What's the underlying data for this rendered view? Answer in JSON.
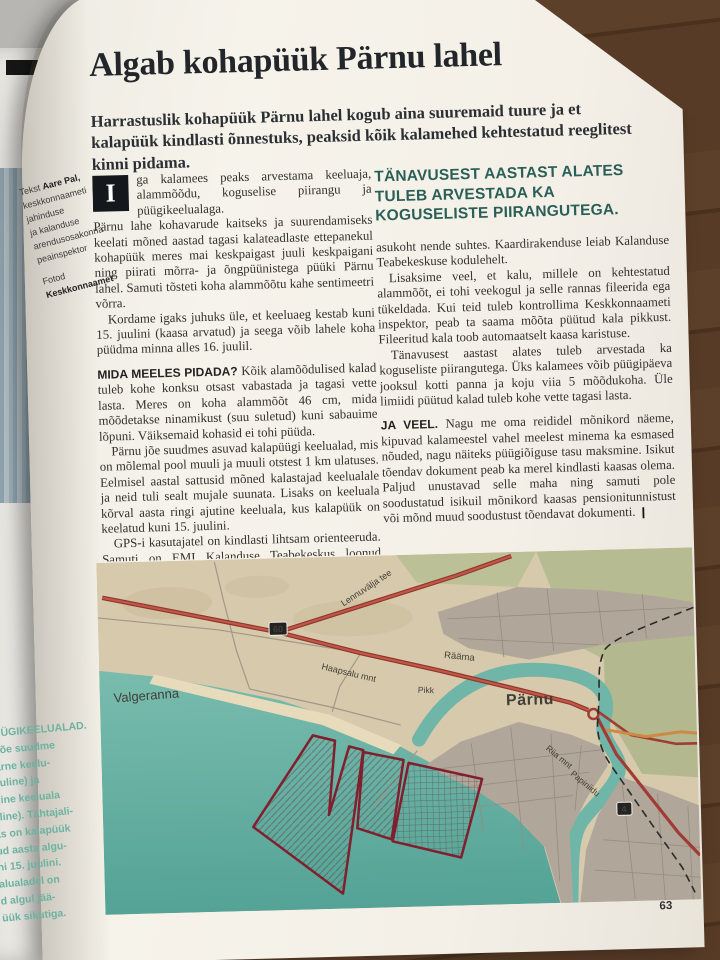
{
  "page": {
    "number": "63"
  },
  "article": {
    "title": "Algab kohapüük Pärnu lahel",
    "lede": "Harrastuslik kohapüük Pärnu lahel kogub aina suuremaid tuure ja et kalapüük kindlasti õnnestuks, peaksid kõik kalamehed kehtestatud reeglitest kinni pidama.",
    "credit": {
      "prefix": "Tekst",
      "name": "Aare Pal,",
      "lines": [
        "keskkonnaameti",
        "jahinduse",
        "ja kalanduse",
        "arendusosakonna",
        "peainspektor"
      ],
      "photo_prefix": "Fotod",
      "photo_credit": "Keskkonnaamet"
    },
    "dropcap": "I",
    "left": {
      "p1": "ga kalamees peaks arvestama keeluaja, alammõõdu, koguselise piirangu ja püügikeelualaga.",
      "p2": "Pärnu lahe kohavarude kaitseks ja suurendamiseks keelati mõned aastad tagasi kalateadlaste ettepanekul kohapüük meres mai keskpaigast juuli keskpaigani ning piirati mõrra- ja õngpüünistega püüki Pärnu lahel. Samuti tõsteti koha alammõõtu kahe sentimeetri võrra.",
      "p3": "Kordame igaks juhuks üle, et keeluaeg kestab kuni 15. juulini (kaasa arvatud) ja seega võib lahele koha püüdma minna alles 16. juulil.",
      "h1": "MIDA MEELES PIDADA?",
      "p4": "Kõik alamõõdulised kalad tuleb kohe konksu otsast vabastada ja tagasi vette lasta. Meres on koha alammõõt 46 cm, mida mõõdetakse ninamikust (suu suletud) kuni sabauime lõpuni. Väiksemaid kohasid ei tohi püüda.",
      "p5": "Pärnu jõe suudmes asuvad kalapüügi keelualad, mis on mõlemal pool muuli ja muuli otstest 1 km ulatuses. Eelmisel aastal sattusid mõned kalastajad keelualale ja neid tuli sealt mujale suunata. Lisaks on keeluala kõrval aasta ringi ajutine keeluala, kus kalapüük on keelatud kuni 15. juulini.",
      "p6": "GPS-i kasutajatel on kindlasti lihtsam orienteeruda. Samuti on EMI Kalanduse Teabekeskus loonud nutisõbraliku kaardirakenduse, milles on võimalik keelualasid kaardil näha ja määrata enda"
    },
    "callout": "TÄNAVUSEST AASTAST ALATES TULEB ARVESTADA KA KOGUSELISTE PIIRANGUTEGA.",
    "right": {
      "p1": "asukoht nende suhtes. Kaardirakenduse leiab Kalanduse Teabekeskuse kodulehelt.",
      "p2": "Lisaksime veel, et kalu, millele on kehtestatud alammõõt, ei tohi veekogul ja selle rannas fileerida ega tükeldada. Kui teid tuleb kontrollima Keskkonnaameti inspektor, peab ta saama mõõta püütud kala pikkust. Fileeritud kala toob automaatselt kaasa karistuse.",
      "p3": "Tänavusest aastast alates tuleb arvestada ka koguseliste piirangutega. Üks kalamees võib püügipäeva jooksul kotti panna ja koju viia 5 mõõdukoha. Üle limiidi püütud kalad tuleb kohe vette tagasi lasta.",
      "h2": "JA VEEL.",
      "p4": "Nagu me oma reididel mõnikord näeme, kipuvad kalameestel vahel meelest minema ka esmased nõuded, nagu näiteks püügiõiguse tasu maksmine. Isikut tõendav dokument peab ka merel kindlasti kaasas olema. Paljud unustavad selle maha ning samuti pole soodustatud isikuil mõnikord kaasas pensionitunnistust või mõnd muud soodustust tõendavat dokumenti.",
      "endmark": "❙"
    }
  },
  "sidebar_legend": {
    "lines": [
      "PÜÜGIKEELUALAD.",
      "u jõe suudme",
      "aarne keelu-",
      "ibuline) ja",
      "aline keeluala",
      "uline). Tähtajali-",
      "as on kalapüük",
      "ud aasta algu-",
      "ni 15. juulini.",
      "alualadel on",
      "d algul jää-",
      "üük sikutiga."
    ]
  },
  "map": {
    "labels": {
      "valgeranna": "Valgeranna",
      "lennuvalja": "Lennuvälja tee",
      "haapsalu": "Haapsalu mnt",
      "raama": "Rääma",
      "pikk": "Pikk",
      "parnu": "Pärnu",
      "riia": "Riia mnt",
      "papiniidu": "Papiniidu",
      "shield_60": "60",
      "shield_4": "4"
    }
  },
  "colors": {
    "callout_teal": "#2a5f58",
    "legend_teal": "#6cb2a1",
    "sea": "#67b0a4",
    "land": "#d7c9ab",
    "restricted_outline": "#801f2d",
    "road_red": "#b5473c"
  }
}
